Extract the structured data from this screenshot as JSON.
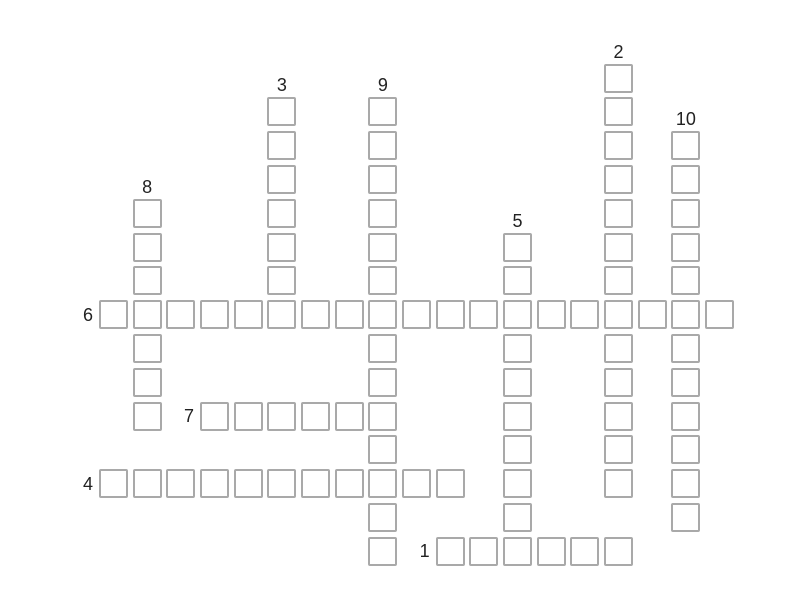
{
  "page": {
    "background": "#ffffff"
  },
  "crossword": {
    "grid": {
      "columns": 19,
      "rows": 15,
      "origin_x": 99,
      "origin_y": 63.5,
      "pitch_x": 33.67,
      "pitch_y": 33.8,
      "cell_size": 29,
      "cell_border_color": "#a9a9a9",
      "cell_fill_color": "#ffffff",
      "number_color": "#222222"
    },
    "words": [
      {
        "number": "1",
        "direction": "across",
        "col": 10,
        "row": 14,
        "length": 6
      },
      {
        "number": "2",
        "direction": "down",
        "col": 15,
        "row": 0,
        "length": 13
      },
      {
        "number": "3",
        "direction": "down",
        "col": 5,
        "row": 1,
        "length": 7
      },
      {
        "number": "4",
        "direction": "across",
        "col": 0,
        "row": 12,
        "length": 11
      },
      {
        "number": "5",
        "direction": "down",
        "col": 12,
        "row": 5,
        "length": 10
      },
      {
        "number": "6",
        "direction": "across",
        "col": 0,
        "row": 7,
        "length": 19
      },
      {
        "number": "7",
        "direction": "across",
        "col": 3,
        "row": 10,
        "length": 6
      },
      {
        "number": "8",
        "direction": "down",
        "col": 1,
        "row": 4,
        "length": 7
      },
      {
        "number": "9",
        "direction": "down",
        "col": 8,
        "row": 1,
        "length": 14
      },
      {
        "number": "10",
        "direction": "down",
        "col": 17,
        "row": 2,
        "length": 12
      }
    ]
  }
}
